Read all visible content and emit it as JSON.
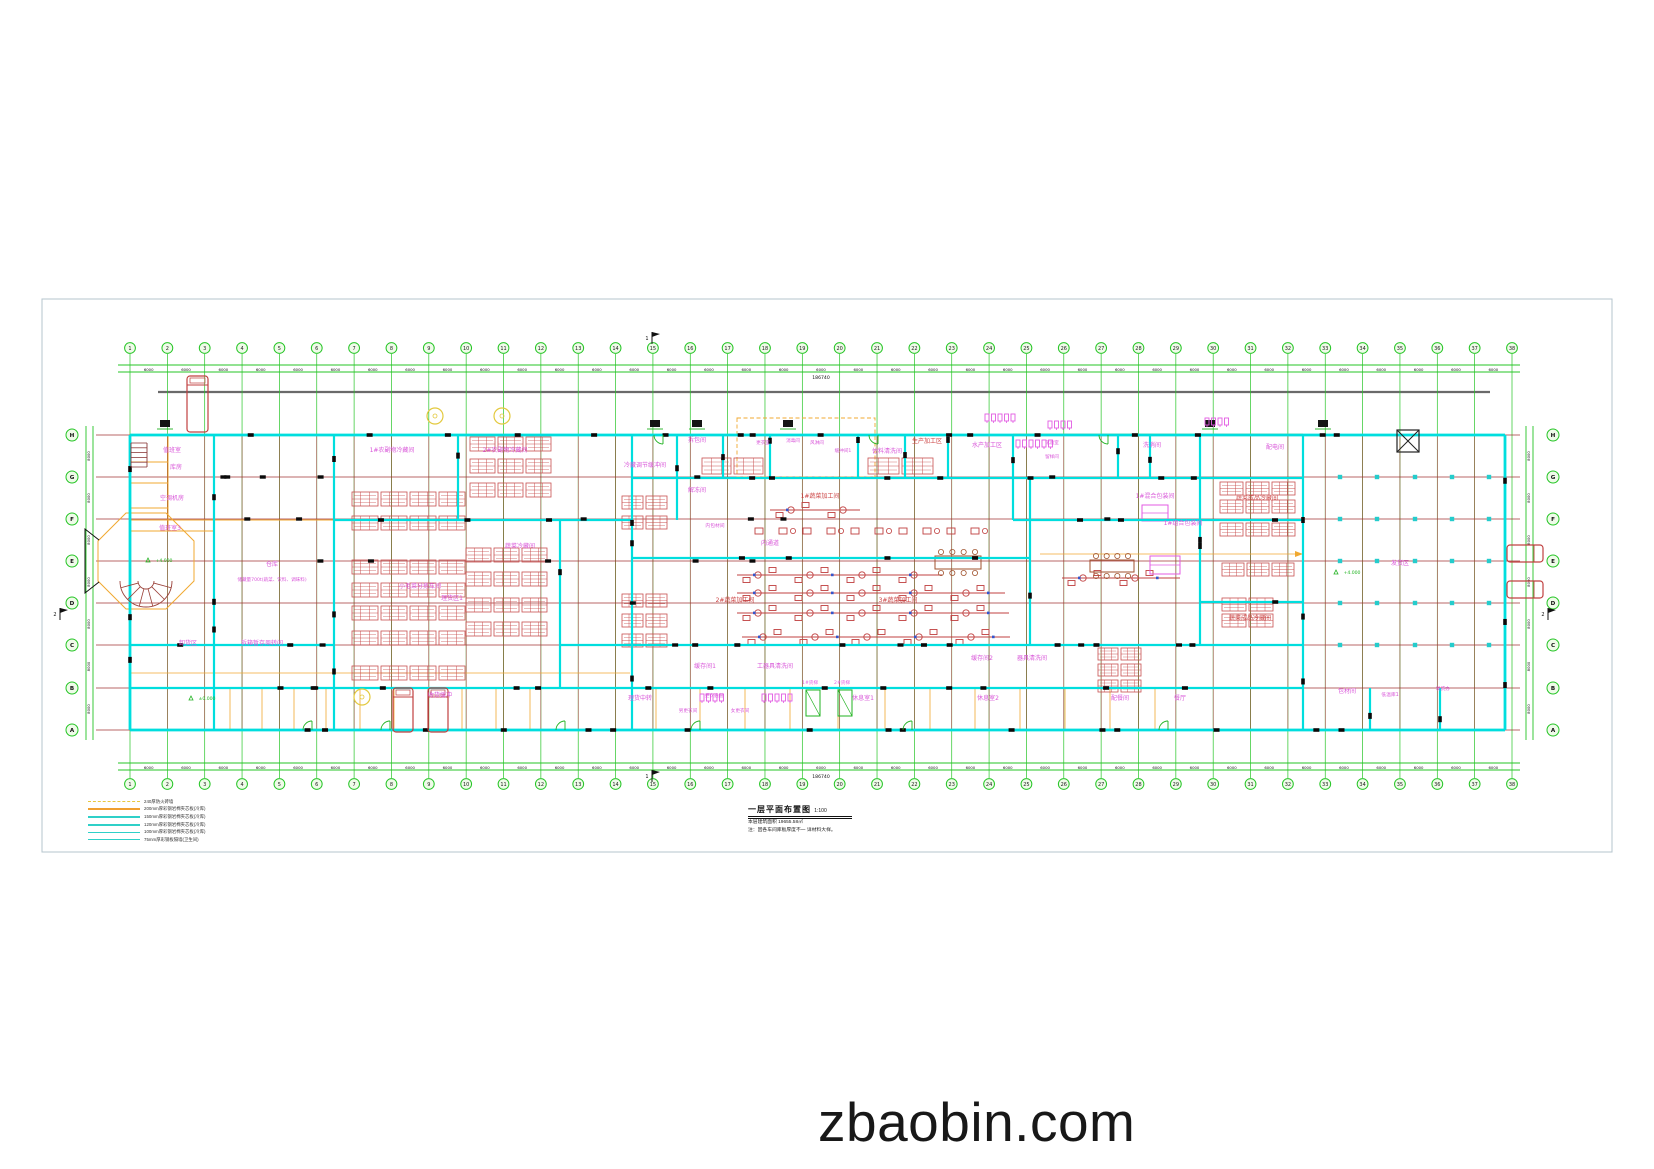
{
  "page": {
    "watermark": "zbaobin.com",
    "background": "#ffffff",
    "panel_border": "#b5c4cd"
  },
  "colors": {
    "grid_green": "#25c525",
    "axis_red": "#a23535",
    "wall_cyan": "#00dede",
    "orange": "#f0a830",
    "rack_red": "#c85050",
    "machine_red": "#c04040",
    "magenta": "#d957d9",
    "red_label": "#cc4444",
    "pink": "#e35be3",
    "green_fix": "#21b321",
    "dim_black": "#111111",
    "gray": "#6a6a6a",
    "yellow": "#e3c93e",
    "blue": "#3355cc",
    "bubble_fill": "#effbe9"
  },
  "drawing": {
    "title": "一层平面布置图",
    "scale": "1:100",
    "notes": [
      "本层建筑面积 19655.58㎡",
      "注：因各车间库板厚度不一 详材料大样。"
    ],
    "legend": [
      {
        "label": "240厚防火砖墙",
        "color": "#e8c840",
        "dash": true,
        "w": 1.2
      },
      {
        "label": "200mm厚彩钢岩棉夹芯板(冷库)",
        "color": "#f0a030",
        "dash": false,
        "w": 2.0
      },
      {
        "label": "150mm厚彩钢岩棉夹芯板(冷库)",
        "color": "#2fd0c8",
        "dash": false,
        "w": 2.6
      },
      {
        "label": "120mm厚彩钢岩棉夹芯板(冷库)",
        "color": "#2fd0c8",
        "dash": false,
        "w": 2.2
      },
      {
        "label": "100mm厚彩钢岩棉夹芯板(冷库)",
        "color": "#2fd0c8",
        "dash": false,
        "w": 1.8
      },
      {
        "label": "75mm厚彩钢板隔墙(卫生间)",
        "color": "#2fd0c8",
        "dash": false,
        "w": 1.1
      }
    ],
    "grid": {
      "columns": {
        "count": 38,
        "x_start": 130,
        "x_end": 1512,
        "bubble_top_y": 348,
        "bubble_bottom_y": 784,
        "dim_label": "6000",
        "total_label": "186740"
      },
      "rows": {
        "letters": [
          "H",
          "G",
          "F",
          "E",
          "D",
          "C",
          "B",
          "A"
        ],
        "ys": [
          435,
          477,
          519,
          561,
          603,
          645,
          688,
          730
        ],
        "left_bubble_x": 72,
        "right_bubble_x": 1553,
        "dim_label": "8000"
      }
    },
    "rooms": [
      [
        "值班室",
        172,
        452
      ],
      [
        "库房",
        176,
        469
      ],
      [
        "空调机房",
        172,
        500
      ],
      [
        "值班室3",
        170,
        530
      ],
      [
        "仓库",
        272,
        566
      ],
      [
        "储藏量700t(蔬菜、饮料、调味料)",
        272,
        581,
        "m",
        4.6
      ],
      [
        "卸货区",
        188,
        645
      ],
      [
        "拆箱暂存周转间",
        262,
        645
      ],
      [
        "收货缓冲",
        440,
        697
      ],
      [
        "1#农副物冷藏间",
        392,
        452
      ],
      [
        "2#农副物冷藏间",
        505,
        452
      ],
      [
        "冷藏调节缓冲间",
        645,
        467
      ],
      [
        "拆包间",
        697,
        442
      ],
      [
        "更衣室",
        763,
        444,
        "m",
        4.6
      ],
      [
        "消毒间",
        793,
        442,
        "m",
        4.6
      ],
      [
        "风淋间",
        817,
        444,
        "m",
        4.6
      ],
      [
        "缓冲间1",
        843,
        452,
        "m",
        4.6
      ],
      [
        "佐料清洗间",
        887,
        453
      ],
      [
        "生产加工区",
        927,
        443,
        "r"
      ],
      [
        "水产加工区",
        987,
        447
      ],
      [
        "化验室",
        1052,
        444,
        "m",
        4.6
      ],
      [
        "留样间",
        1052,
        458,
        "m",
        4.6
      ],
      [
        "洗消间",
        1152,
        447
      ],
      [
        "配电间",
        1275,
        449
      ],
      [
        "解冻间",
        697,
        492
      ],
      [
        "1#蔬菜加工间",
        820,
        498,
        "r"
      ],
      [
        "内包材间",
        715,
        527,
        "m",
        4.8
      ],
      [
        "内通道",
        770,
        545
      ],
      [
        "小毛菜分拣车间",
        420,
        588
      ],
      [
        "理货区1",
        452,
        600
      ],
      [
        "蔬菜冷藏间",
        520,
        548
      ],
      [
        "1#混合包装间",
        1155,
        498
      ],
      [
        "蔬菜成品冷藏间",
        1257,
        500,
        "r"
      ],
      [
        "1#组合包装间",
        1183,
        525
      ],
      [
        "蔬菜成品冷藏间",
        1250,
        620,
        "r"
      ],
      [
        "2#蔬菜加工间",
        735,
        602,
        "r"
      ],
      [
        "3#蔬菜加工间",
        898,
        602,
        "r"
      ],
      [
        "缓存间1",
        705,
        668
      ],
      [
        "工器具清洗间",
        775,
        668
      ],
      [
        "缓存间2",
        982,
        660
      ],
      [
        "器具清洗间",
        1032,
        660
      ],
      [
        "理货中转",
        640,
        700
      ],
      [
        "更衣通道",
        714,
        697,
        "m",
        4.6
      ],
      [
        "男更衣间",
        688,
        712,
        "m",
        4.6
      ],
      [
        "女更衣间",
        740,
        712,
        "m",
        4.6
      ],
      [
        "1#货梯",
        810,
        684,
        "p",
        4.6
      ],
      [
        "2#货梯",
        842,
        684,
        "p",
        4.6
      ],
      [
        "休息室1",
        863,
        700
      ],
      [
        "休息室2",
        988,
        700
      ],
      [
        "配餐间",
        1120,
        700
      ],
      [
        "餐厅",
        1180,
        700
      ],
      [
        "发货区",
        1400,
        565
      ],
      [
        "包材间",
        1347,
        693
      ],
      [
        "低温库1",
        1390,
        696,
        "m",
        4.8
      ],
      [
        "发货办",
        1443,
        690,
        "m",
        4.8
      ]
    ],
    "geometry": {
      "panel": [
        42,
        299,
        1570,
        553
      ],
      "gray_line": [
        158,
        392,
        1490,
        392
      ],
      "walls": [
        [
          130,
          435,
          1505,
          435,
          2.8
        ],
        [
          1505,
          435,
          1505,
          730,
          2.8
        ],
        [
          130,
          730,
          1505,
          730,
          2.8
        ],
        [
          130,
          435,
          130,
          730,
          2.8
        ],
        [
          214,
          435,
          214,
          730
        ],
        [
          334,
          435,
          334,
          730
        ],
        [
          458,
          435,
          458,
          520
        ],
        [
          560,
          520,
          560,
          688
        ],
        [
          632,
          435,
          632,
          730
        ],
        [
          677,
          435,
          677,
          520
        ],
        [
          723,
          435,
          723,
          478
        ],
        [
          770,
          435,
          770,
          478
        ],
        [
          858,
          435,
          858,
          478
        ],
        [
          905,
          435,
          905,
          478
        ],
        [
          948,
          435,
          948,
          478
        ],
        [
          1013,
          435,
          1013,
          520
        ],
        [
          1030,
          478,
          1030,
          645
        ],
        [
          1118,
          435,
          1118,
          478
        ],
        [
          1150,
          435,
          1150,
          478
        ],
        [
          1200,
          435,
          1200,
          645
        ],
        [
          1303,
          435,
          1303,
          730
        ],
        [
          1370,
          688,
          1370,
          730
        ],
        [
          1440,
          688,
          1440,
          730
        ],
        [
          334,
          520,
          632,
          520
        ],
        [
          632,
          478,
          1303,
          478
        ],
        [
          1013,
          520,
          1303,
          520
        ],
        [
          632,
          558,
          1030,
          558
        ],
        [
          560,
          645,
          1303,
          645
        ],
        [
          130,
          645,
          334,
          645
        ],
        [
          130,
          688,
          1303,
          688
        ],
        [
          1200,
          602,
          1303,
          602
        ]
      ],
      "partitions": {
        "lines": [
          [
            168,
            435,
            168,
            531
          ],
          [
            130,
            462,
            168,
            462
          ],
          [
            130,
            483,
            168,
            483
          ],
          [
            130,
            508,
            168,
            508
          ],
          [
            130,
            531,
            214,
            531
          ],
          [
            130,
            520,
            334,
            520
          ]
        ],
        "bottom_xs": [
          230,
          262,
          294,
          326,
          360,
          394,
          428,
          462,
          496,
          530,
          656,
          700,
          745,
          790,
          838,
          885,
          930,
          975,
          1020,
          1065,
          1110,
          1155
        ],
        "long": [
          [
            1013,
            434,
            1303,
            434
          ],
          [
            130,
            673,
            630,
            673
          ],
          [
            1040,
            554,
            1295,
            554
          ]
        ],
        "dashed_rect": [
          737,
          418,
          138,
          59
        ],
        "octagon": "126,513 166,513 194,541 194,581 166,609 126,609 98,581 98,541"
      },
      "racks": [
        {
          "x": 352,
          "cols": 4,
          "cw": 26,
          "ch": 14,
          "ys": [
            492,
            516
          ]
        },
        {
          "x": 352,
          "cols": 4,
          "cw": 26,
          "ch": 14,
          "ys": [
            560,
            583,
            606,
            631,
            666
          ]
        },
        {
          "x": 470,
          "cols": 3,
          "cw": 25,
          "ch": 14,
          "ys": [
            437,
            459,
            483
          ]
        },
        {
          "x": 466,
          "cols": 3,
          "cw": 25,
          "ch": 14,
          "ys": [
            548,
            572,
            598,
            622
          ]
        },
        {
          "x": 622,
          "cols": 2,
          "cw": 21,
          "ch": 13,
          "ys": [
            496,
            516,
            594,
            614,
            634
          ]
        },
        {
          "x": 702,
          "cols": 2,
          "cw": 29,
          "ch": 16,
          "ys": [
            458
          ]
        },
        {
          "x": 868,
          "cols": 2,
          "cw": 31,
          "ch": 16,
          "ys": [
            458
          ]
        },
        {
          "x": 1220,
          "cols": 3,
          "cw": 23,
          "ch": 13,
          "ys": [
            482,
            500,
            523
          ]
        },
        {
          "x": 1222,
          "cols": 3,
          "cw": 22,
          "ch": 13,
          "ys": [
            563
          ]
        },
        {
          "x": 1222,
          "cols": 2,
          "cw": 24,
          "ch": 13,
          "ys": [
            598,
            614
          ]
        },
        {
          "x": 1098,
          "cols": 2,
          "cw": 20,
          "ch": 12,
          "ys": [
            648,
            664,
            680
          ]
        }
      ],
      "conveyors": [
        [
          737,
          575,
          205
        ],
        [
          737,
          593,
          268
        ],
        [
          737,
          613,
          272
        ],
        [
          742,
          637,
          268
        ],
        [
          1062,
          578,
          118
        ],
        [
          770,
          510,
          90
        ]
      ],
      "machine_rows": [
        [
          755,
          531,
          255
        ]
      ],
      "tables": [
        [
          935,
          556,
          46,
          13
        ],
        [
          1090,
          560,
          44,
          12
        ]
      ],
      "fixtures_magenta": [
        [
          985,
          414,
          5
        ],
        [
          1016,
          440,
          6
        ],
        [
          1048,
          421,
          4
        ],
        [
          700,
          694,
          4
        ],
        [
          762,
          694,
          5
        ],
        [
          1205,
          418,
          4
        ]
      ],
      "machines_pink": [
        [
          1142,
          505,
          26,
          16
        ],
        [
          1150,
          556,
          30,
          18
        ]
      ],
      "lifts": [
        [
          806,
          690,
          14,
          26
        ],
        [
          838,
          690,
          14,
          26
        ]
      ],
      "doors_bottom": [
        312,
        390,
        565,
        700,
        912,
        1168
      ],
      "doors_top": [
        663,
        878,
        1108
      ],
      "elevations": [
        [
          150,
          560,
          "+4.000"
        ],
        [
          193,
          698,
          "±0.000"
        ],
        [
          1338,
          572,
          "+4.000"
        ]
      ],
      "yellow_circles": [
        [
          435,
          416
        ],
        [
          502,
          416
        ],
        [
          362,
          697
        ]
      ],
      "cyan_dots": {
        "xs": [
          1340,
          1377,
          1415,
          1452,
          1489
        ],
        "ys": [
          477,
          519,
          561,
          603,
          645
        ]
      },
      "docks": [
        165,
        655,
        697,
        788,
        1210,
        1323
      ],
      "crossbox": [
        1397,
        430,
        22
      ],
      "trucks_v": [
        [
          187,
          376,
          21,
          56
        ],
        [
          393,
          688,
          20,
          44
        ],
        [
          428,
          688,
          20,
          44
        ]
      ],
      "trucks_h": [
        [
          1507,
          545,
          36,
          17
        ],
        [
          1507,
          581,
          36,
          17
        ]
      ],
      "stair_fan": {
        "cx": 146,
        "cy": 581
      },
      "ladder": [
        131,
        443,
        16,
        24
      ],
      "flags": [
        [
          652,
          338,
          "1"
        ],
        [
          652,
          776,
          "1"
        ],
        [
          60,
          614,
          "2"
        ],
        [
          1548,
          614,
          "2"
        ]
      ]
    }
  }
}
